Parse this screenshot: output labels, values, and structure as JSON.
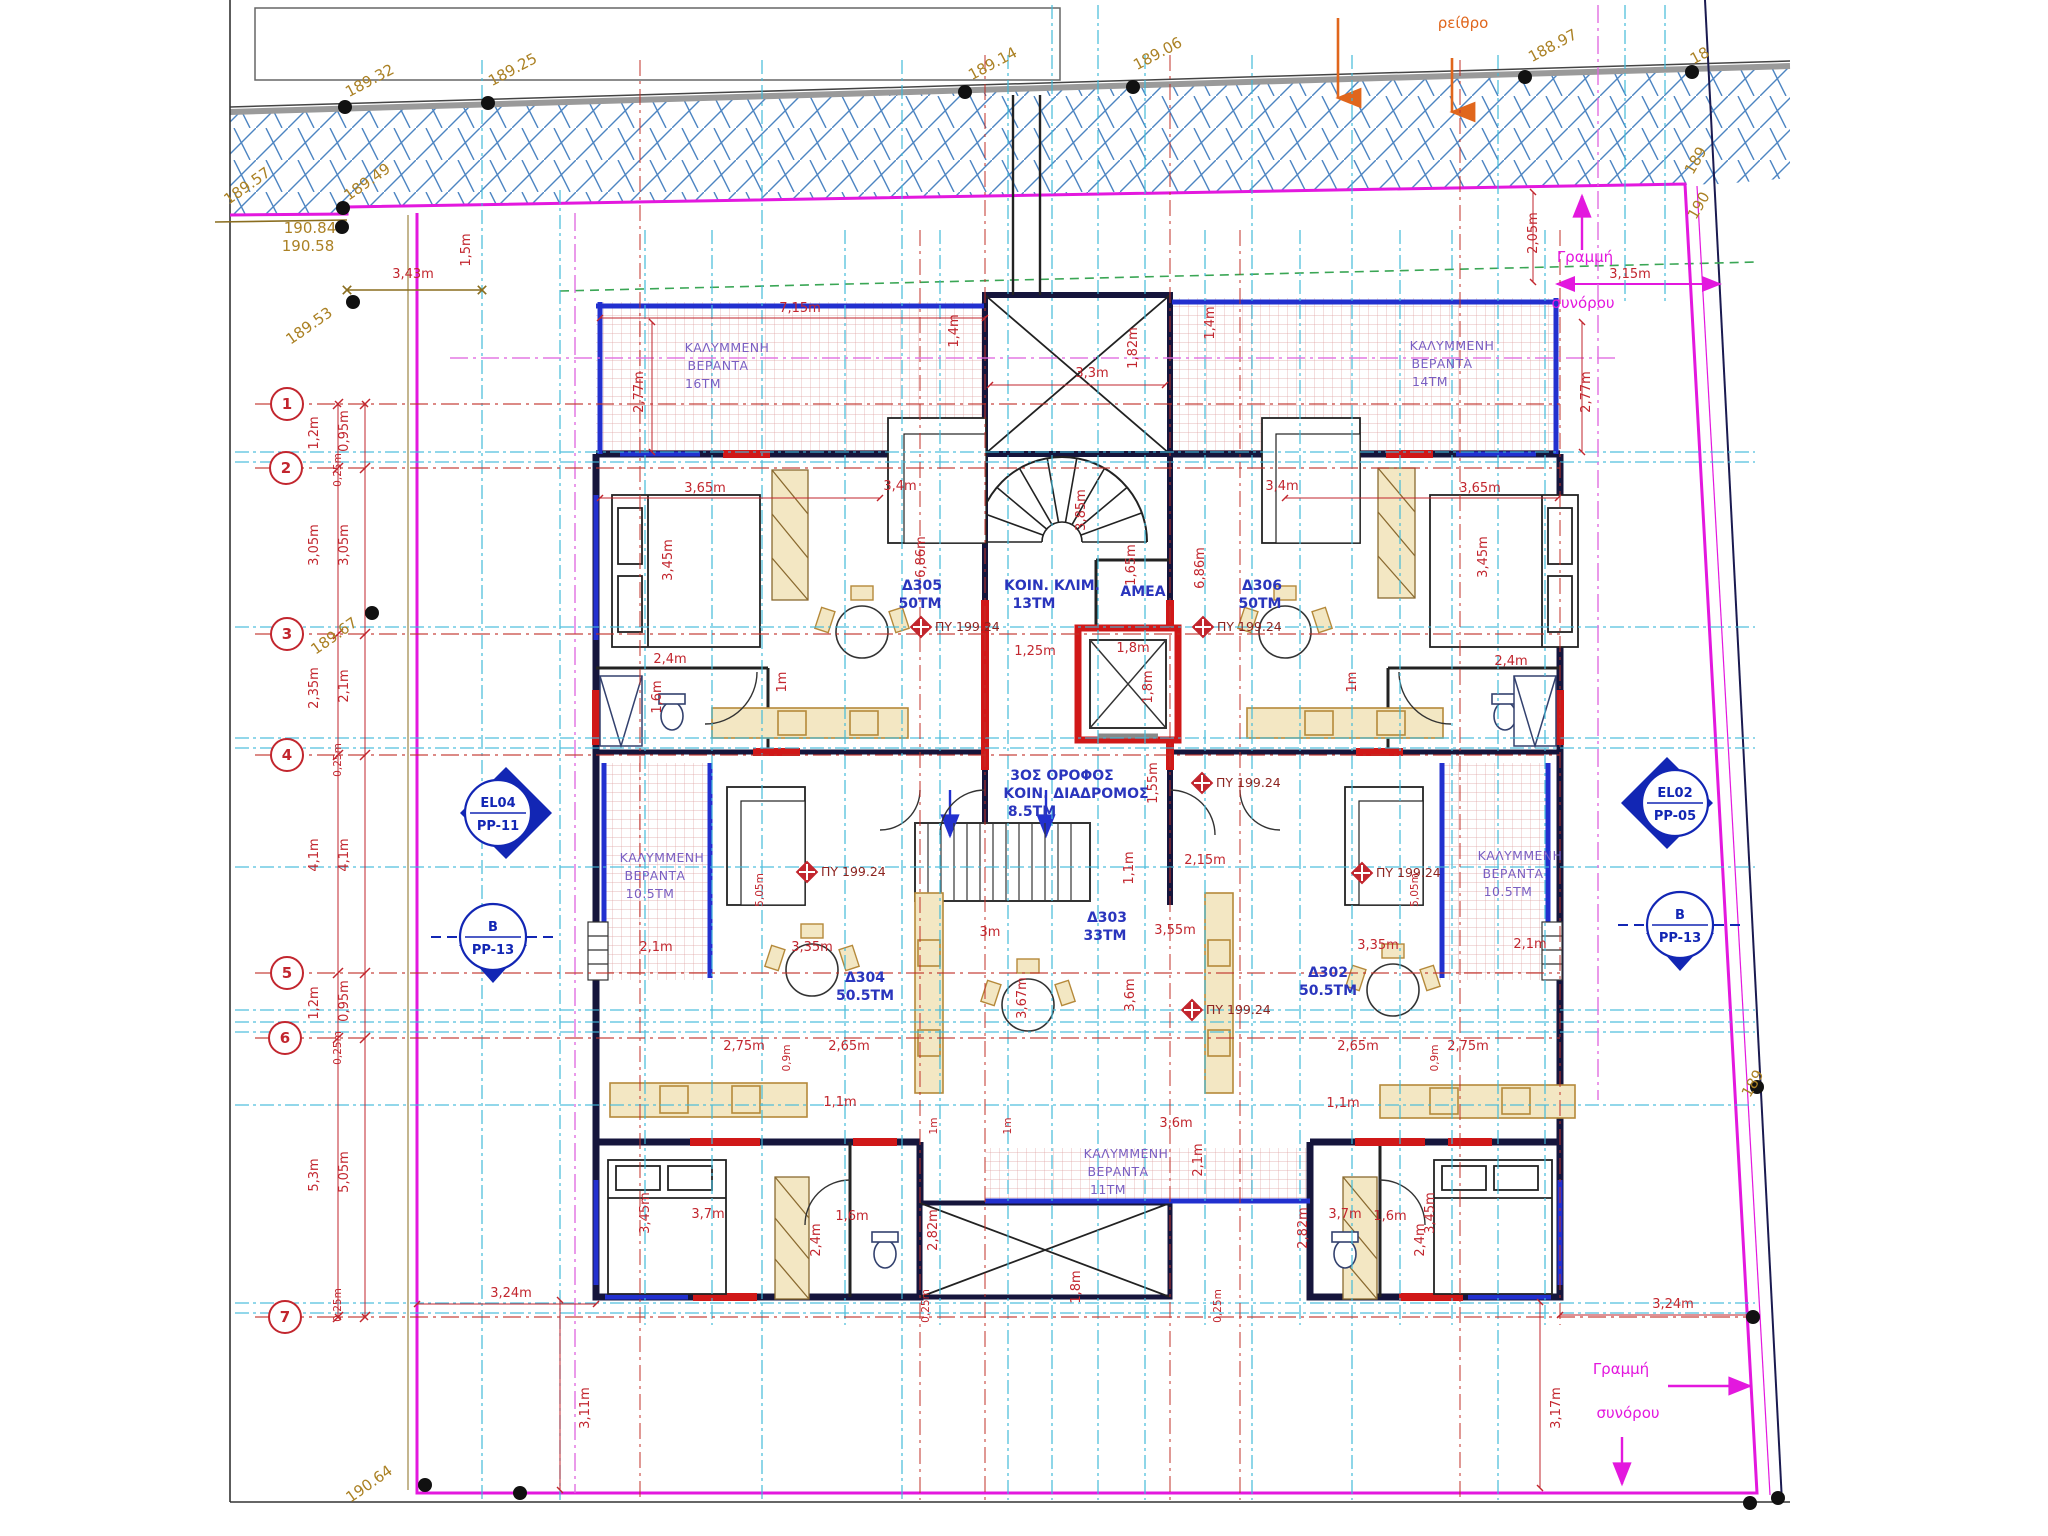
{
  "boundary_label": {
    "line1": "Γραμμή",
    "line2": "συνόρου"
  },
  "street_label": "ρείθρο",
  "py_markers": {
    "label": "ΠΥ 199.24",
    "points": [
      {
        "x": 921,
        "y": 627
      },
      {
        "x": 1203,
        "y": 627
      },
      {
        "x": 1202,
        "y": 783
      },
      {
        "x": 807,
        "y": 872
      },
      {
        "x": 1192,
        "y": 1010
      },
      {
        "x": 1362,
        "y": 873
      }
    ]
  },
  "grid_bubbles": [
    {
      "n": "1",
      "x": 287,
      "y": 404
    },
    {
      "n": "2",
      "x": 286,
      "y": 468
    },
    {
      "n": "3",
      "x": 287,
      "y": 634
    },
    {
      "n": "4",
      "x": 287,
      "y": 755
    },
    {
      "n": "5",
      "x": 287,
      "y": 973
    },
    {
      "n": "6",
      "x": 285,
      "y": 1038
    },
    {
      "n": "7",
      "x": 285,
      "y": 1317
    }
  ],
  "section_markers": [
    {
      "line1": "EL04",
      "line2": "PP-11",
      "x": 498,
      "y": 813,
      "dir": "right"
    },
    {
      "line1": "EL02",
      "line2": "PP-05",
      "x": 1675,
      "y": 803,
      "dir": "left"
    },
    {
      "line1": "B",
      "line2": "PP-13",
      "x": 493,
      "y": 937,
      "dir": "down"
    },
    {
      "line1": "B",
      "line2": "PP-13",
      "x": 1680,
      "y": 925,
      "dir": "down"
    }
  ],
  "benchmark_dots": [
    {
      "x": 345,
      "y": 107
    },
    {
      "x": 488,
      "y": 103
    },
    {
      "x": 965,
      "y": 92
    },
    {
      "x": 1133,
      "y": 87
    },
    {
      "x": 1525,
      "y": 77
    },
    {
      "x": 1692,
      "y": 72
    },
    {
      "x": 343,
      "y": 208
    },
    {
      "x": 342,
      "y": 227
    },
    {
      "x": 353,
      "y": 302
    },
    {
      "x": 372,
      "y": 613
    },
    {
      "x": 425,
      "y": 1485
    },
    {
      "x": 520,
      "y": 1493
    },
    {
      "x": 1753,
      "y": 1317
    },
    {
      "x": 1750,
      "y": 1503
    },
    {
      "x": 1778,
      "y": 1498
    },
    {
      "x": 1757,
      "y": 1087
    }
  ],
  "labels": [
    {
      "t": "189.32",
      "x": 372,
      "y": 85,
      "r": -28,
      "c": "e"
    },
    {
      "t": "189.25",
      "x": 515,
      "y": 74,
      "r": -28,
      "c": "e"
    },
    {
      "t": "189.14",
      "x": 995,
      "y": 68,
      "r": -28,
      "c": "e"
    },
    {
      "t": "189.06",
      "x": 1160,
      "y": 58,
      "r": -28,
      "c": "e"
    },
    {
      "t": "188.97",
      "x": 1555,
      "y": 50,
      "r": -28,
      "c": "e"
    },
    {
      "t": "18",
      "x": 1702,
      "y": 60,
      "r": -28,
      "c": "e"
    },
    {
      "t": "189.57",
      "x": 250,
      "y": 190,
      "r": -35,
      "c": "e"
    },
    {
      "t": "189.49",
      "x": 370,
      "y": 186,
      "r": -35,
      "c": "e"
    },
    {
      "t": "190.84",
      "x": 310,
      "y": 233,
      "r": 0,
      "c": "e"
    },
    {
      "t": "190.58",
      "x": 308,
      "y": 251,
      "r": 0,
      "c": "e"
    },
    {
      "t": "189.53",
      "x": 312,
      "y": 330,
      "r": -35,
      "c": "e"
    },
    {
      "t": "189.67",
      "x": 337,
      "y": 640,
      "r": -35,
      "c": "e"
    },
    {
      "t": "190.64",
      "x": 372,
      "y": 1488,
      "r": -35,
      "c": "e"
    },
    {
      "t": "189",
      "x": 1700,
      "y": 163,
      "r": -60,
      "c": "e"
    },
    {
      "t": "190",
      "x": 1703,
      "y": 208,
      "r": -60,
      "c": "e"
    },
    {
      "t": "189",
      "x": 1757,
      "y": 1086,
      "r": -60,
      "c": "e"
    },
    {
      "t": "ρείθρο",
      "x": 1463,
      "y": 28,
      "r": 0,
      "c": "o"
    },
    {
      "t": "Γραμμή",
      "x": 1585,
      "y": 262,
      "r": 0,
      "c": "m"
    },
    {
      "t": "συνόρου",
      "x": 1583,
      "y": 308,
      "r": 0,
      "c": "m"
    },
    {
      "t": "Γραμμή",
      "x": 1621,
      "y": 1374,
      "r": 0,
      "c": "m"
    },
    {
      "t": "συνόρου",
      "x": 1628,
      "y": 1418,
      "r": 0,
      "c": "m"
    },
    {
      "t": "3,15m",
      "x": 1630,
      "y": 278,
      "r": 0,
      "c": "d"
    },
    {
      "t": "2,05m",
      "x": 1537,
      "y": 233,
      "r": -90,
      "c": "d"
    },
    {
      "t": "3,43m",
      "x": 413,
      "y": 278,
      "r": 0,
      "c": "d"
    },
    {
      "t": "1,5m",
      "x": 470,
      "y": 250,
      "r": -90,
      "c": "d"
    },
    {
      "t": "7,15m",
      "x": 800,
      "y": 312,
      "r": 0,
      "c": "d"
    },
    {
      "t": "1,4m",
      "x": 958,
      "y": 331,
      "r": -90,
      "c": "d"
    },
    {
      "t": "1,4m",
      "x": 1214,
      "y": 323,
      "r": -90,
      "c": "d"
    },
    {
      "t": "3,3m",
      "x": 1092,
      "y": 377,
      "r": 0,
      "c": "d"
    },
    {
      "t": "1,82m",
      "x": 1137,
      "y": 348,
      "r": -90,
      "c": "d"
    },
    {
      "t": "2,77m",
      "x": 643,
      "y": 392,
      "r": -90,
      "c": "d"
    },
    {
      "t": "2,77m",
      "x": 1590,
      "y": 392,
      "r": -90,
      "c": "d"
    },
    {
      "t": "1,2m",
      "x": 318,
      "y": 433,
      "r": -90,
      "c": "d"
    },
    {
      "t": "0,95m",
      "x": 348,
      "y": 431,
      "r": -90,
      "c": "d"
    },
    {
      "t": "0,25m",
      "x": 341,
      "y": 470,
      "r": -90,
      "c": "ds"
    },
    {
      "t": "3,05m",
      "x": 318,
      "y": 545,
      "r": -90,
      "c": "d"
    },
    {
      "t": "3,05m",
      "x": 348,
      "y": 545,
      "r": -90,
      "c": "d"
    },
    {
      "t": "2,35m",
      "x": 318,
      "y": 688,
      "r": -90,
      "c": "d"
    },
    {
      "t": "2,1m",
      "x": 348,
      "y": 686,
      "r": -90,
      "c": "d"
    },
    {
      "t": "0,25m",
      "x": 341,
      "y": 760,
      "r": -90,
      "c": "ds"
    },
    {
      "t": "4,1m",
      "x": 318,
      "y": 855,
      "r": -90,
      "c": "d"
    },
    {
      "t": "4,1m",
      "x": 348,
      "y": 855,
      "r": -90,
      "c": "d"
    },
    {
      "t": "1,2m",
      "x": 318,
      "y": 1003,
      "r": -90,
      "c": "d"
    },
    {
      "t": "0,95m",
      "x": 348,
      "y": 1001,
      "r": -90,
      "c": "d"
    },
    {
      "t": "0,25m",
      "x": 341,
      "y": 1048,
      "r": -90,
      "c": "ds"
    },
    {
      "t": "5,3m",
      "x": 318,
      "y": 1175,
      "r": -90,
      "c": "d"
    },
    {
      "t": "5,05m",
      "x": 348,
      "y": 1172,
      "r": -90,
      "c": "d"
    },
    {
      "t": "0,25m",
      "x": 341,
      "y": 1305,
      "r": -90,
      "c": "ds"
    },
    {
      "t": "3,65m",
      "x": 705,
      "y": 492,
      "r": 0,
      "c": "d"
    },
    {
      "t": "3,65m",
      "x": 1480,
      "y": 492,
      "r": 0,
      "c": "d"
    },
    {
      "t": "3,45m",
      "x": 672,
      "y": 560,
      "r": -90,
      "c": "d"
    },
    {
      "t": "3,45m",
      "x": 1487,
      "y": 557,
      "r": -90,
      "c": "d"
    },
    {
      "t": "3,4m",
      "x": 900,
      "y": 490,
      "r": 0,
      "c": "d"
    },
    {
      "t": "3,4m",
      "x": 1282,
      "y": 490,
      "r": 0,
      "c": "d"
    },
    {
      "t": "6,86m",
      "x": 925,
      "y": 557,
      "r": -90,
      "c": "d"
    },
    {
      "t": "6,86m",
      "x": 1204,
      "y": 568,
      "r": -90,
      "c": "d"
    },
    {
      "t": "2,4m",
      "x": 670,
      "y": 663,
      "r": 0,
      "c": "d"
    },
    {
      "t": "2,4m",
      "x": 1511,
      "y": 665,
      "r": 0,
      "c": "d"
    },
    {
      "t": "1,6m",
      "x": 661,
      "y": 697,
      "r": -90,
      "c": "d"
    },
    {
      "t": "1m",
      "x": 786,
      "y": 682,
      "r": -90,
      "c": "d"
    },
    {
      "t": "1m",
      "x": 1356,
      "y": 682,
      "r": -90,
      "c": "d"
    },
    {
      "t": "1,25m",
      "x": 1035,
      "y": 655,
      "r": 0,
      "c": "d"
    },
    {
      "t": "1,8m",
      "x": 1133,
      "y": 652,
      "r": 0,
      "c": "d"
    },
    {
      "t": "1,8m",
      "x": 1152,
      "y": 687,
      "r": -90,
      "c": "d"
    },
    {
      "t": "1,65m",
      "x": 1135,
      "y": 565,
      "r": -90,
      "c": "d"
    },
    {
      "t": "3,85m",
      "x": 1085,
      "y": 510,
      "r": -90,
      "c": "d"
    },
    {
      "t": "1,55m",
      "x": 1157,
      "y": 783,
      "r": -90,
      "c": "d"
    },
    {
      "t": "1,1m",
      "x": 1133,
      "y": 868,
      "r": -90,
      "c": "d"
    },
    {
      "t": "2,15m",
      "x": 1205,
      "y": 864,
      "r": 0,
      "c": "d"
    },
    {
      "t": "3m",
      "x": 990,
      "y": 936,
      "r": 0,
      "c": "d"
    },
    {
      "t": "3,55m",
      "x": 1175,
      "y": 934,
      "r": 0,
      "c": "d"
    },
    {
      "t": "3,67m",
      "x": 1026,
      "y": 998,
      "r": -90,
      "c": "d"
    },
    {
      "t": "3,6m",
      "x": 1134,
      "y": 995,
      "r": -90,
      "c": "d"
    },
    {
      "t": "3,35m",
      "x": 812,
      "y": 951,
      "r": 0,
      "c": "d"
    },
    {
      "t": "3,35m",
      "x": 1378,
      "y": 949,
      "r": 0,
      "c": "d"
    },
    {
      "t": "2,1m",
      "x": 656,
      "y": 951,
      "r": 0,
      "c": "d"
    },
    {
      "t": "2,1m",
      "x": 1530,
      "y": 948,
      "r": 0,
      "c": "d"
    },
    {
      "t": "2,75m",
      "x": 744,
      "y": 1050,
      "r": 0,
      "c": "d"
    },
    {
      "t": "2,65m",
      "x": 849,
      "y": 1050,
      "r": 0,
      "c": "d"
    },
    {
      "t": "2,65m",
      "x": 1358,
      "y": 1050,
      "r": 0,
      "c": "d"
    },
    {
      "t": "2,75m",
      "x": 1468,
      "y": 1050,
      "r": 0,
      "c": "d"
    },
    {
      "t": "0,9m",
      "x": 790,
      "y": 1058,
      "r": -90,
      "c": "ds"
    },
    {
      "t": "0,9m",
      "x": 1438,
      "y": 1058,
      "r": -90,
      "c": "ds"
    },
    {
      "t": "1,1m",
      "x": 840,
      "y": 1106,
      "r": 0,
      "c": "d"
    },
    {
      "t": "1,1m",
      "x": 1343,
      "y": 1107,
      "r": 0,
      "c": "d"
    },
    {
      "t": "3,6m",
      "x": 1176,
      "y": 1127,
      "r": 0,
      "c": "d"
    },
    {
      "t": "2,1m",
      "x": 1202,
      "y": 1160,
      "r": -90,
      "c": "d"
    },
    {
      "t": "1m",
      "x": 937,
      "y": 1126,
      "r": -90,
      "c": "ds"
    },
    {
      "t": "1m",
      "x": 1011,
      "y": 1126,
      "r": -90,
      "c": "ds"
    },
    {
      "t": "5,05m",
      "x": 763,
      "y": 890,
      "r": -90,
      "c": "ds"
    },
    {
      "t": "5,05m",
      "x": 1418,
      "y": 890,
      "r": -90,
      "c": "ds"
    },
    {
      "t": "3,45m",
      "x": 649,
      "y": 1213,
      "r": -90,
      "c": "d"
    },
    {
      "t": "3,7m",
      "x": 708,
      "y": 1218,
      "r": 0,
      "c": "d"
    },
    {
      "t": "3,7m",
      "x": 1345,
      "y": 1218,
      "r": 0,
      "c": "d"
    },
    {
      "t": "3,45m",
      "x": 1434,
      "y": 1213,
      "r": -90,
      "c": "d"
    },
    {
      "t": "2,4m",
      "x": 820,
      "y": 1240,
      "r": -90,
      "c": "d"
    },
    {
      "t": "1,6m",
      "x": 852,
      "y": 1220,
      "r": 0,
      "c": "d"
    },
    {
      "t": "1,6m",
      "x": 1390,
      "y": 1220,
      "r": 0,
      "c": "d"
    },
    {
      "t": "2,82m",
      "x": 937,
      "y": 1230,
      "r": -90,
      "c": "d"
    },
    {
      "t": "2,82m",
      "x": 1307,
      "y": 1228,
      "r": -90,
      "c": "d"
    },
    {
      "t": "2,4m",
      "x": 1424,
      "y": 1240,
      "r": -90,
      "c": "d"
    },
    {
      "t": "1,8m",
      "x": 1080,
      "y": 1287,
      "r": -90,
      "c": "d"
    },
    {
      "t": "0,25m",
      "x": 929,
      "y": 1306,
      "r": -90,
      "c": "ds"
    },
    {
      "t": "0,25m",
      "x": 1221,
      "y": 1306,
      "r": -90,
      "c": "ds"
    },
    {
      "t": "3,24m",
      "x": 511,
      "y": 1297,
      "r": 0,
      "c": "d"
    },
    {
      "t": "3,24m",
      "x": 1673,
      "y": 1308,
      "r": 0,
      "c": "d"
    },
    {
      "t": "3,11m",
      "x": 589,
      "y": 1408,
      "r": -90,
      "c": "d"
    },
    {
      "t": "3,17m",
      "x": 1560,
      "y": 1408,
      "r": -90,
      "c": "d"
    },
    {
      "t": "ΚΑΛΥΜΜΕΝΗ",
      "x": 727,
      "y": 352,
      "r": 0,
      "c": "r"
    },
    {
      "t": "ΒΕΡΑΝΤΑ",
      "x": 718,
      "y": 370,
      "r": 0,
      "c": "r"
    },
    {
      "t": "16ΤΜ",
      "x": 703,
      "y": 388,
      "r": 0,
      "c": "r"
    },
    {
      "t": "ΚΑΛΥΜΜΕΝΗ",
      "x": 1452,
      "y": 350,
      "r": 0,
      "c": "r"
    },
    {
      "t": "ΒΕΡΑΝΤΑ",
      "x": 1442,
      "y": 368,
      "r": 0,
      "c": "r"
    },
    {
      "t": "14ΤΜ",
      "x": 1430,
      "y": 386,
      "r": 0,
      "c": "r"
    },
    {
      "t": "ΚΑΛΥΜΜΕΝΗ",
      "x": 662,
      "y": 862,
      "r": 0,
      "c": "r"
    },
    {
      "t": "ΒΕΡΑΝΤΑ",
      "x": 655,
      "y": 880,
      "r": 0,
      "c": "r"
    },
    {
      "t": "10.5ΤΜ",
      "x": 650,
      "y": 898,
      "r": 0,
      "c": "r"
    },
    {
      "t": "ΚΑΛΥΜΜΕΝΗ",
      "x": 1520,
      "y": 860,
      "r": 0,
      "c": "r"
    },
    {
      "t": "ΒΕΡΑΝΤΑ",
      "x": 1513,
      "y": 878,
      "r": 0,
      "c": "r"
    },
    {
      "t": "10.5ΤΜ",
      "x": 1508,
      "y": 896,
      "r": 0,
      "c": "r"
    },
    {
      "t": "ΚΑΛΥΜΜΕΝΗ",
      "x": 1126,
      "y": 1158,
      "r": 0,
      "c": "r"
    },
    {
      "t": "ΒΕΡΑΝΤΑ",
      "x": 1118,
      "y": 1176,
      "r": 0,
      "c": "r"
    },
    {
      "t": "11ΤΜ",
      "x": 1108,
      "y": 1194,
      "r": 0,
      "c": "r"
    },
    {
      "t": "Δ305",
      "x": 922,
      "y": 590,
      "r": 0,
      "c": "a"
    },
    {
      "t": "50ΤΜ",
      "x": 920,
      "y": 608,
      "r": 0,
      "c": "a"
    },
    {
      "t": "Δ306",
      "x": 1262,
      "y": 590,
      "r": 0,
      "c": "a"
    },
    {
      "t": "50ΤΜ",
      "x": 1260,
      "y": 608,
      "r": 0,
      "c": "a"
    },
    {
      "t": "Δ304",
      "x": 865,
      "y": 982,
      "r": 0,
      "c": "a"
    },
    {
      "t": "50.5ΤΜ",
      "x": 865,
      "y": 1000,
      "r": 0,
      "c": "a"
    },
    {
      "t": "Δ302",
      "x": 1328,
      "y": 977,
      "r": 0,
      "c": "a"
    },
    {
      "t": "50.5ΤΜ",
      "x": 1328,
      "y": 995,
      "r": 0,
      "c": "a"
    },
    {
      "t": "Δ303",
      "x": 1107,
      "y": 922,
      "r": 0,
      "c": "a"
    },
    {
      "t": "33ΤΜ",
      "x": 1105,
      "y": 940,
      "r": 0,
      "c": "a"
    },
    {
      "t": "ΚΟΙΝ. ΚΛΙΜ.",
      "x": 1052,
      "y": 590,
      "r": 0,
      "c": "a"
    },
    {
      "t": "13ΤΜ",
      "x": 1034,
      "y": 608,
      "r": 0,
      "c": "a"
    },
    {
      "t": "ΑΜΕΑ",
      "x": 1143,
      "y": 596,
      "r": 0,
      "c": "a"
    },
    {
      "t": "3ΟΣ ΟΡΟΦΟΣ",
      "x": 1062,
      "y": 780,
      "r": 0,
      "c": "a"
    },
    {
      "t": "ΚΟΙΝ. ΔΙΑΔΡΟΜΟΣ",
      "x": 1076,
      "y": 798,
      "r": 0,
      "c": "a"
    },
    {
      "t": "8.5ΤΜ",
      "x": 1032,
      "y": 816,
      "r": 0,
      "c": "a"
    }
  ]
}
